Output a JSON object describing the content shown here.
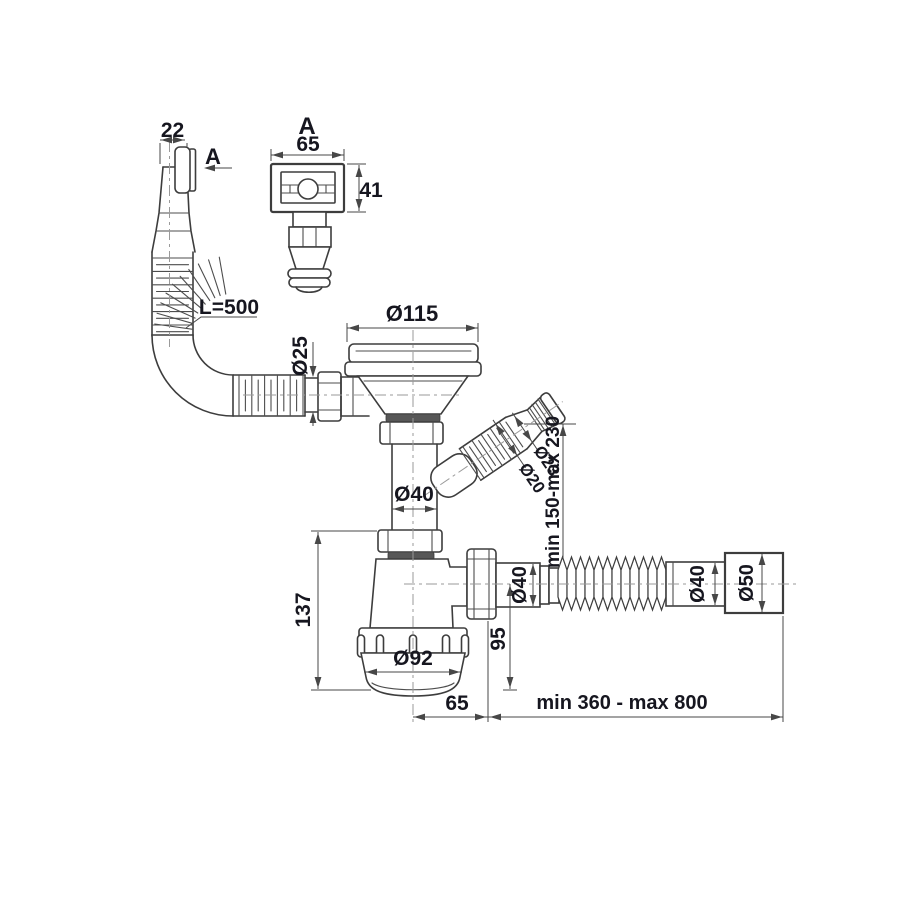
{
  "title": "Sink siphon with overflow - dimensional technical drawing",
  "colors": {
    "background": "#ffffff",
    "outline": "#3d3d3d",
    "dimension_line": "#474747",
    "text": "#16161f",
    "centerline": "#9a9a9a",
    "gasket": "#575757"
  },
  "labels": {
    "overflow_width": "22",
    "section_arrow": "A",
    "detail_title": "A",
    "detail_width": "65",
    "detail_height": "41",
    "hose_length": "L=500",
    "hose_diameter": "Ø25",
    "strainer_diameter": "Ø115",
    "tailpipe_diameter": "Ø40",
    "branch_hose_diameter": "Ø20",
    "branch_end_diameter": "Ø23",
    "branch_height": "min 150-max 230",
    "body_height": "137",
    "cup_diameter": "Ø92",
    "outlet_height": "95",
    "outlet_pipe_diameter": "Ø40",
    "flex_pipe_diameter": "Ø40",
    "flex_end_diameter": "Ø50",
    "outlet_offset": "65",
    "flex_length": "min 360 - max 800"
  }
}
